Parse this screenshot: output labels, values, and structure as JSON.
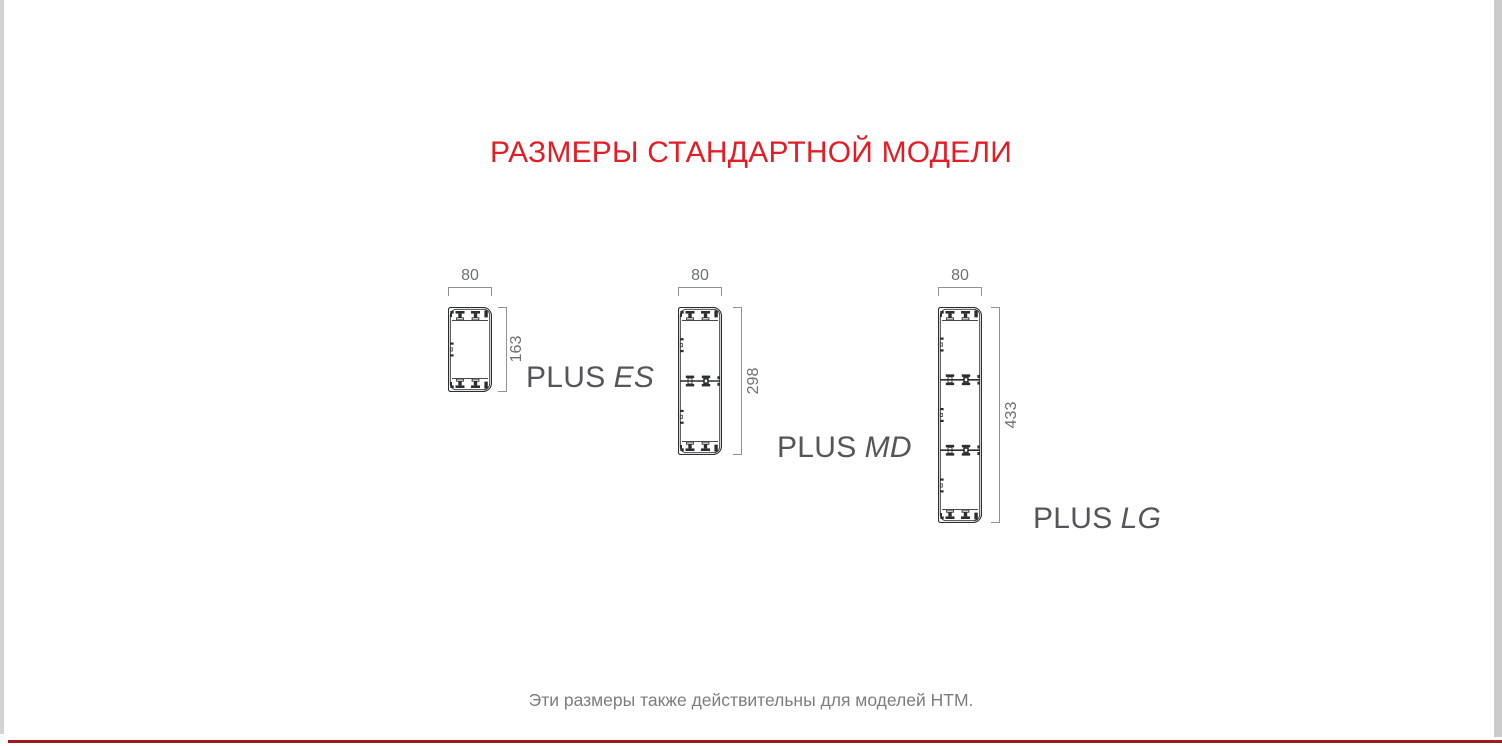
{
  "page": {
    "title": "РАЗМЕРЫ СТАНДАРТНОЙ МОДЕЛИ",
    "note": "Эти размеры также действительны для моделей HTM."
  },
  "colors": {
    "title_red": "#e41d25",
    "bottom_rule_red": "#a1191f",
    "label_gray": "#54565b",
    "dimension_gray": "#6d7174",
    "drawing_line": "#2c2e30"
  },
  "figures": [
    {
      "name": "PLUS ES",
      "series": "PLUS",
      "model": "ES",
      "width_mm": "80",
      "height_mm": "163",
      "sections": 1
    },
    {
      "name": "PLUS MD",
      "series": "PLUS",
      "model": "MD",
      "width_mm": "80",
      "height_mm": "298",
      "sections": 2
    },
    {
      "name": "PLUS LG",
      "series": "PLUS",
      "model": "LG",
      "width_mm": "80",
      "height_mm": "433",
      "sections": 3
    }
  ]
}
